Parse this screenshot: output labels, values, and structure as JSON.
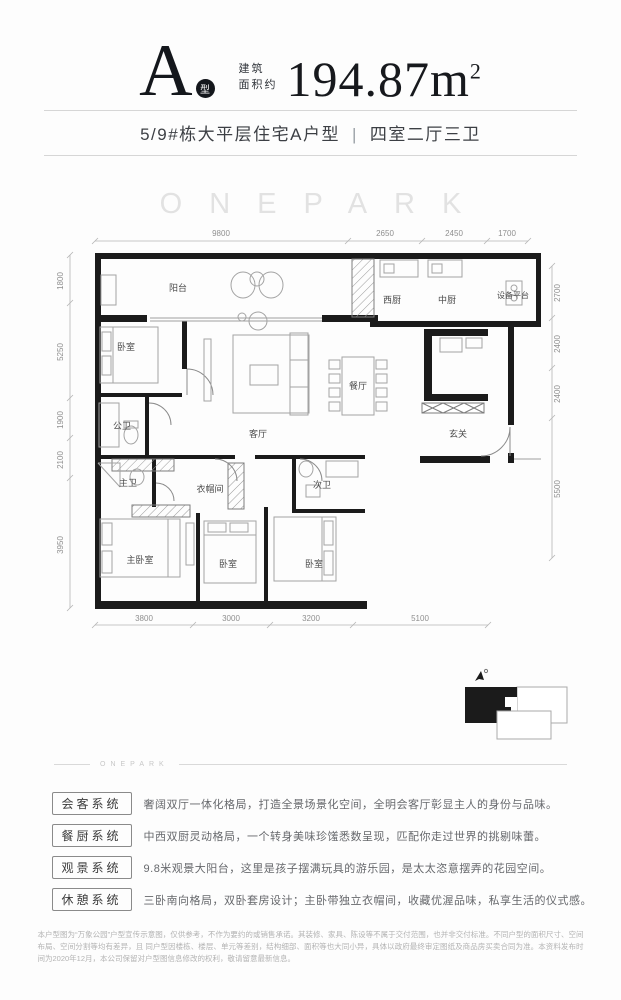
{
  "header": {
    "type_letter": "A",
    "type_badge": "型",
    "area_prefix_line1": "建筑",
    "area_prefix_line2": "面积约",
    "area_value": "194.87",
    "area_unit": "m",
    "area_sup": "2"
  },
  "subtitle": {
    "left": "5/9#栋大平层住宅A户型",
    "separator": "|",
    "right": "四室二厅三卫"
  },
  "watermark": "ONEPARK",
  "plan": {
    "dims_top": [
      "9800",
      "2650",
      "2450",
      "1700"
    ],
    "dims_left": [
      "1800",
      "5250",
      "1900",
      "2100",
      "3950"
    ],
    "dims_right": [
      "2700",
      "2400",
      "2400",
      "5500"
    ],
    "dims_bottom": [
      "3800",
      "3000",
      "3200",
      "5100"
    ],
    "rooms": {
      "balcony": "阳台",
      "west_kitchen": "西厨",
      "chinese_kitchen": "中厨",
      "equipment_platform": "设备平台",
      "bedroom_top": "卧室",
      "living_room": "客厅",
      "dining_room": "餐厅",
      "guest_bathroom": "公卫",
      "foyer": "玄关",
      "master_bathroom": "主卫",
      "cloakroom": "衣帽间",
      "second_bathroom": "次卫",
      "master_bedroom": "主卧室",
      "bedroom_mid": "卧室",
      "bedroom_right": "卧室"
    }
  },
  "divider_watermark": "ONEPARK",
  "features": [
    {
      "tag": "会客系统",
      "text": "奢阔双厅一体化格局，打造全景场景化空间，全明会客厅彰显主人的身份与品味。"
    },
    {
      "tag": "餐厨系统",
      "text": "中西双厨灵动格局，一个转身美味珍馐悉数呈现，匹配你走过世界的挑剔味蕾。"
    },
    {
      "tag": "观景系统",
      "text": "9.8米观景大阳台，这里是孩子摆满玩具的游乐园，是太太恣意摆弄的花园空间。"
    },
    {
      "tag": "休憩系统",
      "text": "三卧南向格局，双卧套房设计；主卧带独立衣帽间，收藏优渥品味，私享生活的仪式感。"
    }
  ],
  "disclaimer": {
    "line1": "本户型图为“万象公园”户型宣传示意图，仅供参考，不作为要约的或销售承诺。其装修、家具、陈设等不属于交付范围，也并非交付标准。不同户型的面积尺寸、空间布局、空间分割等均有差异，且",
    "line2": "同户型因楼栋、楼层、单元等差别，结构细部、面积等也大同小异，具体以政府最终审定图纸及商品房买卖合同为准。本资料发布时间为2020年12月，本公司保留对户型图信息修改的权利，敬请留意最新信息。"
  },
  "colors": {
    "wall": "#1b1b1b",
    "dimension_text": "#8f8f8f",
    "room_label": "#4a4a4a",
    "watermark": "#e2e2e2"
  }
}
